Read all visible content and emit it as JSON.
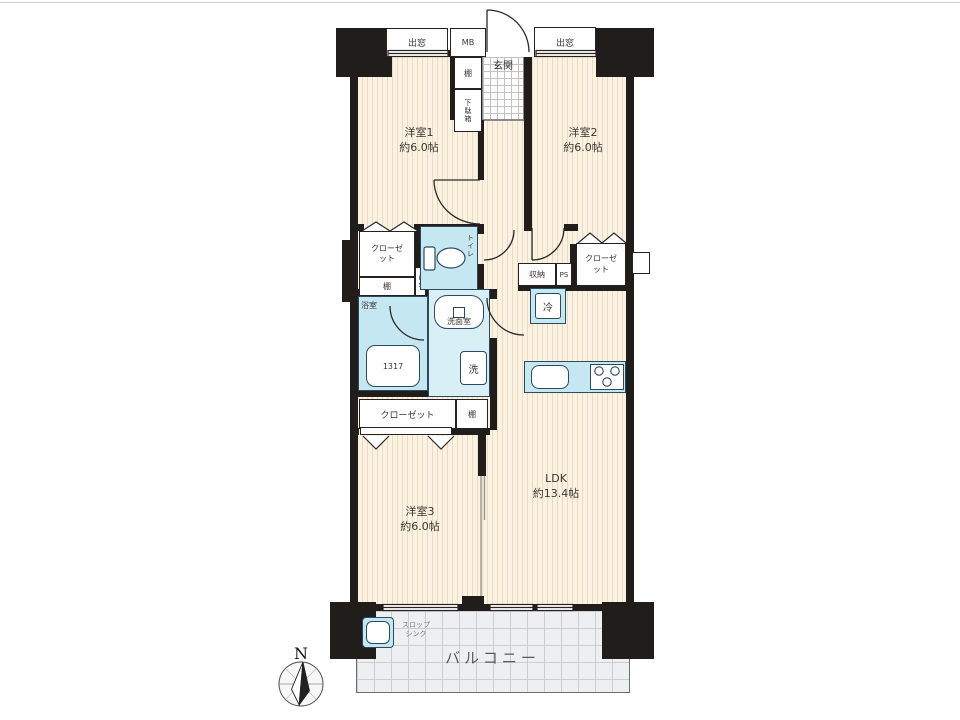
{
  "plan": {
    "compass": {
      "north": "N"
    },
    "rooms": {
      "room1_name": "洋室1",
      "room1_area": "約6.0帖",
      "room2_name": "洋室2",
      "room2_area": "約6.0帖",
      "room3_name": "洋室3",
      "room3_area": "約6.0帖",
      "ldk_name": "LDK",
      "ldk_area": "約13.4帖",
      "entrance": "玄関",
      "balcony": "バルコニー",
      "bathroom": "浴室",
      "washroom": "洗面室",
      "toilet": "トイレ"
    },
    "fixtures": {
      "bay_window_left": "出窓",
      "bay_window_right": "出窓",
      "meter_box": "MB",
      "entry_shelf": "棚",
      "shoe_cabinet": "下駄箱",
      "closet_left": "クローゼット",
      "closet_right": "クローゼット",
      "closet_bottom": "クローゼット",
      "shelf_mid": "棚",
      "shelf_bottom": "棚",
      "storage": "収納",
      "pipe_space_a": "PS",
      "pipe_space_b": "PS",
      "refrigerator": "冷",
      "washing_machine": "洗",
      "bathtub_size": "1317",
      "slop_sink_line1": "スロップ",
      "slop_sink_line2": "シンク"
    },
    "colors": {
      "wall": "#201d1a",
      "floor": "#fbf2e1",
      "floor_stripe": "#eadcc2",
      "wet_area": "#c5e7f2",
      "wet_area_light": "#d9eff6",
      "wet_border": "#2c4a5e",
      "balcony_tile": "#edeff0",
      "text": "#3b3632"
    }
  }
}
